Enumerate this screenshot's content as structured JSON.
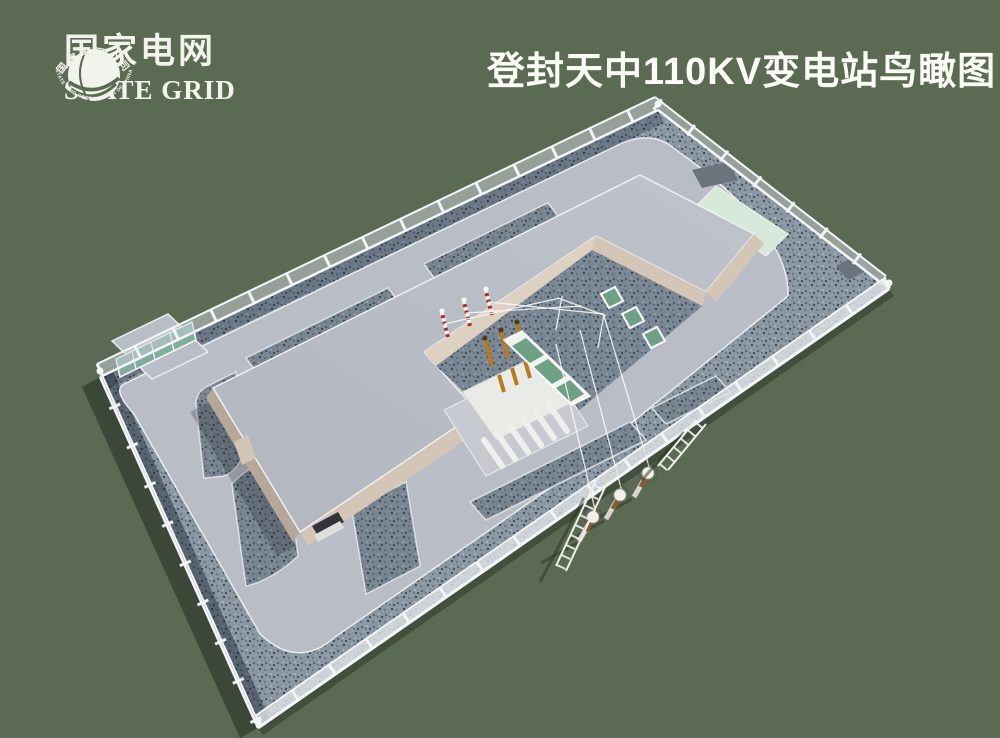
{
  "header": {
    "logo": {
      "name_cn": "国家电网",
      "name_en": "STATE GRID",
      "emblem_top_text": "国家电网公司",
      "emblem_bottom_text": "STATE GRID CORPORATION OF CHINA"
    },
    "title": "登封天中110KV变电站鸟瞰图"
  },
  "colors": {
    "bg": "#5b6b53",
    "titleText": "#fdfdf8",
    "logoText": "#f2f3ec",
    "gravelBase": "#8a96a2",
    "pavement": "#b9bec6",
    "curb": "#e9ecef",
    "roofGray": "#b2b6be",
    "roofGrayLight": "#bfc3cb",
    "roofEdge": "#eef0f2",
    "wallBeige": "#d3c6b6",
    "wallBeigeDark": "#b6a898",
    "wallBright": "#ddd1c1",
    "meshFill": "#c6ccd2",
    "fenceWhite": "#f4f6f7",
    "mintPad": "#d7ead9",
    "padDark": "#6b737d",
    "gateTeal": "#7fae9f",
    "panelGreen": "#6ca183",
    "transformerBody": "#e9ebe7",
    "radiatorFin": "#eef0ec",
    "bushingOrange": "#b87a1d",
    "bushingCap": "#4e3a12",
    "arresterRed": "#b03028",
    "poleBody": "#d8d5cf",
    "poleCollar": "#8a5a35",
    "poleCap": "#f2f1ec",
    "wireWhite": "#fafafa",
    "shadowDark": "#2a3226",
    "entranceDark": "#32343c"
  }
}
